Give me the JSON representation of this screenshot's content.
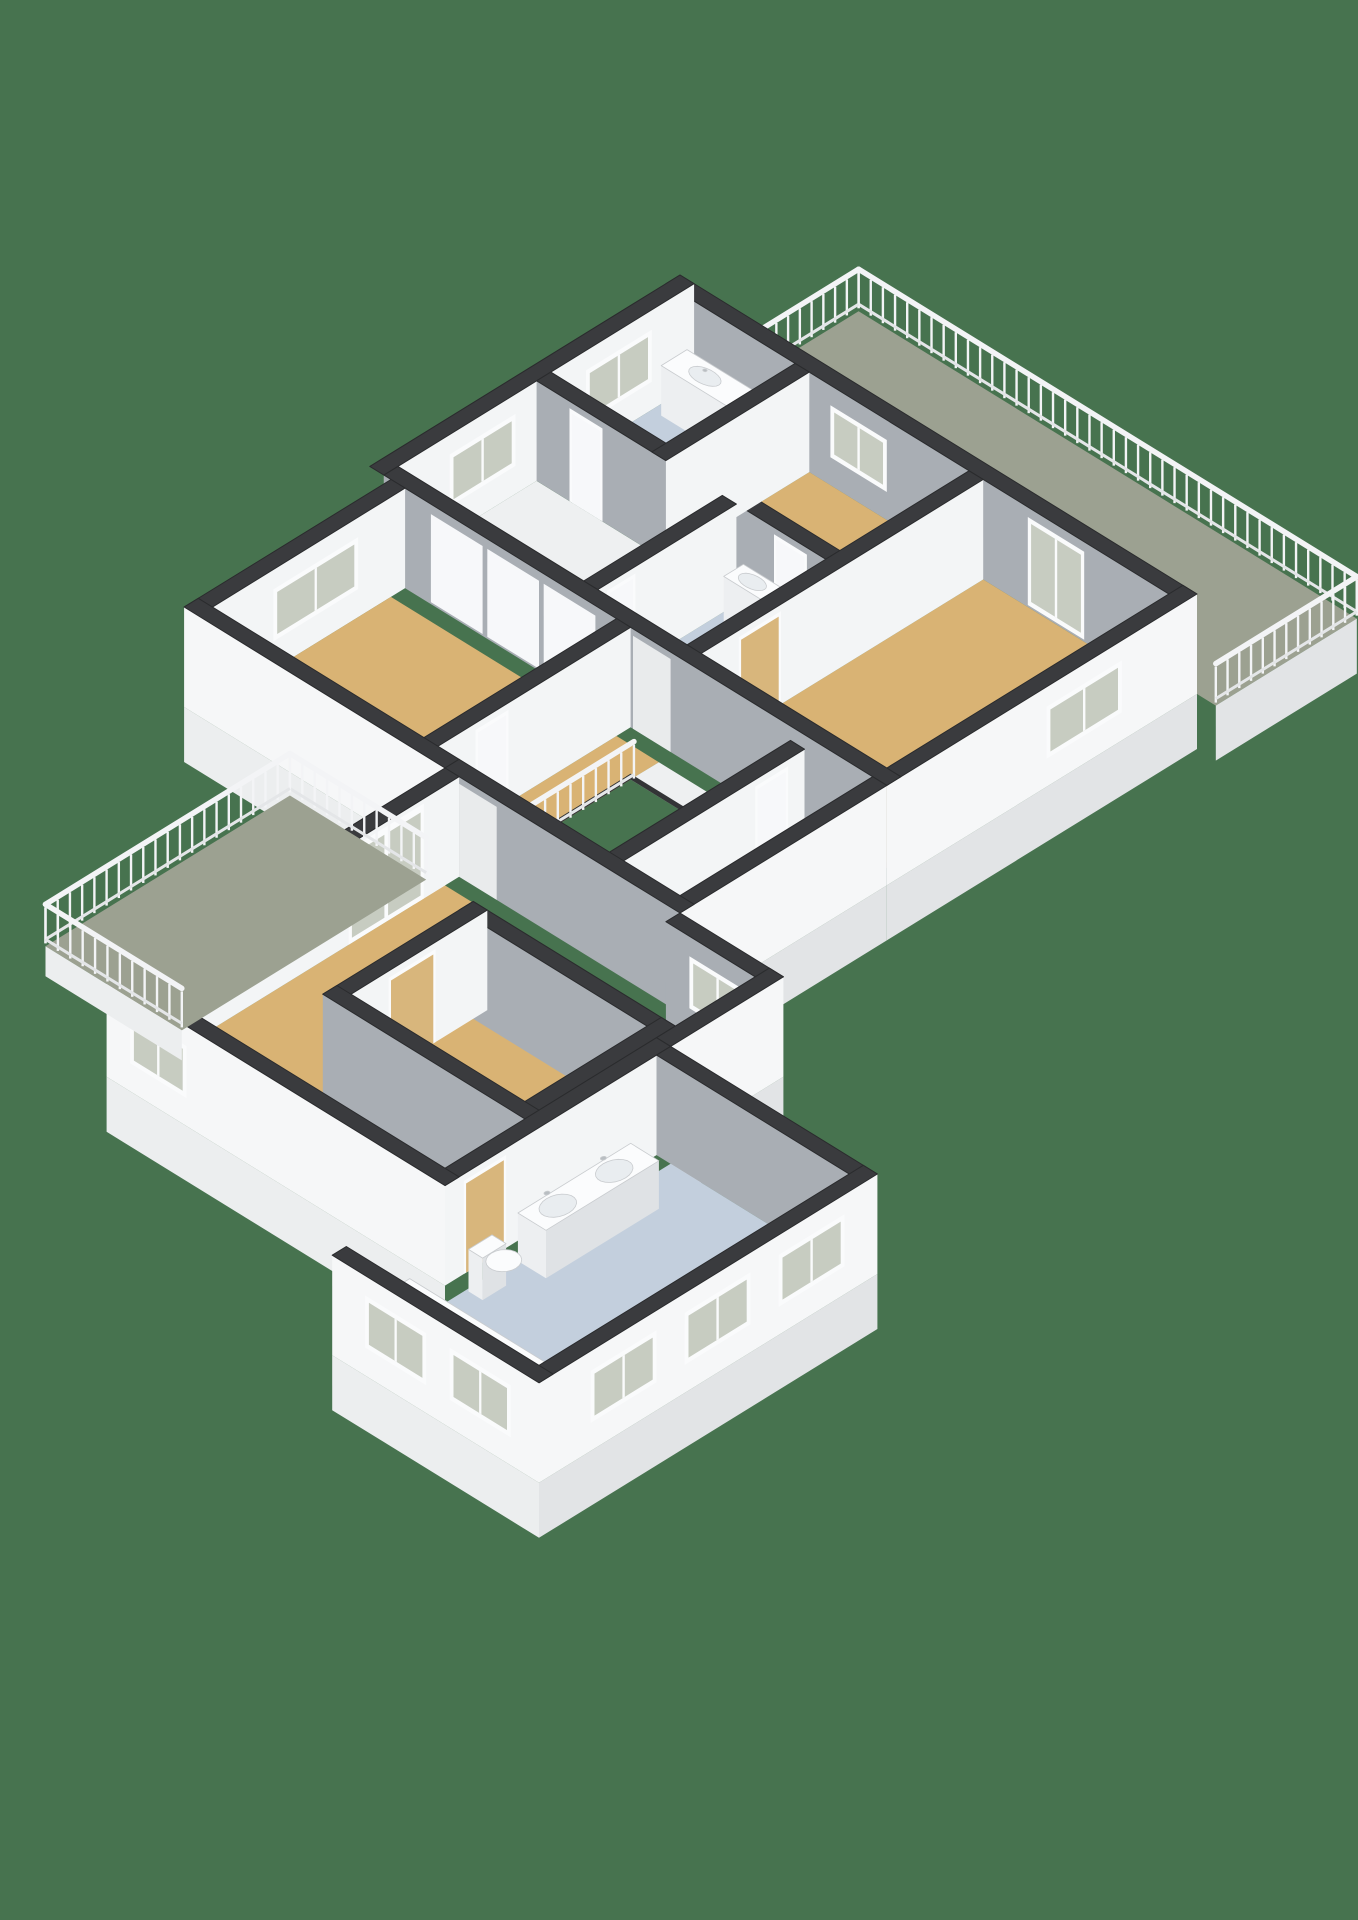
{
  "scene": {
    "type": "3d-floorplan-isometric-render",
    "floor_shown": "upper-floor",
    "background": "#47734F",
    "rooms": [
      {
        "id": "roof-terrace",
        "floor": "deck",
        "features": [
          "balustrade"
        ]
      },
      {
        "id": "bedroom-top",
        "floor": "wood",
        "features": [
          "window"
        ]
      },
      {
        "id": "bathroom-small",
        "floor": "bath",
        "features": [
          "vanity",
          "washing-machine",
          "window"
        ]
      },
      {
        "id": "bedroom-right",
        "floor": "wood",
        "features": [
          "terrace-door",
          "window"
        ]
      },
      {
        "id": "hallway",
        "floor": "hall",
        "features": [
          "wardrobe-doors"
        ]
      },
      {
        "id": "shower-room",
        "floor": "bath",
        "features": [
          "washbasin"
        ]
      },
      {
        "id": "middle-room",
        "floor": "wood",
        "features": [
          "window"
        ]
      },
      {
        "id": "landing",
        "floor": "hall",
        "features": [
          "stair-void",
          "void-railing"
        ]
      },
      {
        "id": "store-room",
        "floor": "wood",
        "features": []
      },
      {
        "id": "master-bedroom",
        "floor": "wood",
        "features": [
          "french-doors",
          "window"
        ]
      },
      {
        "id": "walk-in-closet",
        "floor": "wood",
        "features": [
          "sliding-door"
        ]
      },
      {
        "id": "master-bathroom",
        "floor": "bath",
        "features": [
          "double-vanity",
          "bathtub",
          "toilet",
          "window-band"
        ]
      },
      {
        "id": "balcony",
        "floor": "deck",
        "features": [
          "balustrade",
          "french-doors"
        ]
      }
    ],
    "fixtures": [
      "double-vanity",
      "bathtub",
      "wall-hung-toilet",
      "washbasin",
      "vanity-cabinet",
      "washing-machine"
    ],
    "openings": {
      "windows": 14,
      "french-door-sets": 2,
      "interior-doors": 8,
      "passages": 2
    }
  },
  "colors": {
    "background": "#47734F",
    "wallTop": "#3A3B3E",
    "wallTopStroke": "#2A2B2D",
    "faceWhite": "#F3F5F6",
    "faceWhiteExt": "#F6F7F8",
    "faceGray": "#A9AEB4",
    "slabU": "#E2E4E6",
    "slabV": "#ECEEEF",
    "floorWood": "#D9B374",
    "floorBath": "#C3CFDD",
    "floorHall": "#EEF0F1",
    "floorDeck": "#9CA191",
    "glass": "#C7CCC1",
    "frame": "#FAFBFC",
    "railWhite": "#F3F4F6",
    "railBase": "#E4E6E8",
    "fixWhite": "#FBFCFD",
    "fixFaceV": "#EDEFF1",
    "fixFaceU": "#DFE2E5",
    "fixOutline": "#C9CCCF",
    "basin": "#E9EDF0",
    "doorTan": "#D8B67C",
    "doorWhite": "#F7F8FA",
    "openingFill": "#E9EBEC",
    "voidRim": "#333436",
    "faucet": "#B9BEC2"
  }
}
